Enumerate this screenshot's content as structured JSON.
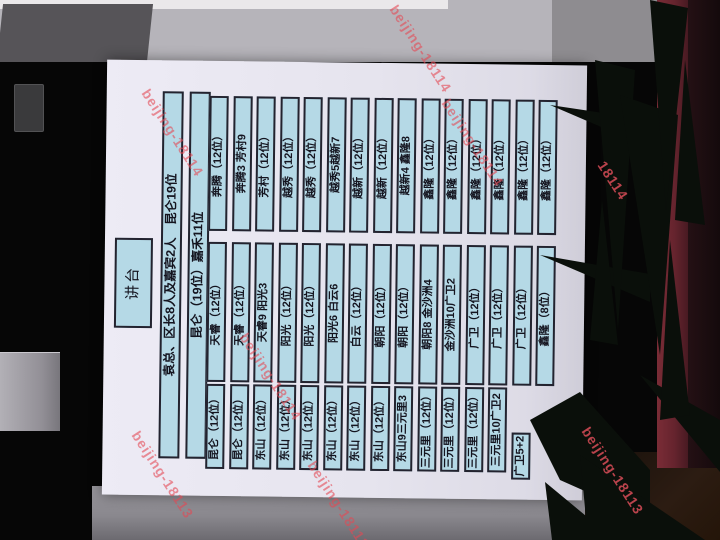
{
  "photo": {
    "watermarks": [
      "beijing-18114",
      "beijing-18114",
      "beijing-18114",
      "beijing-18114",
      "18114",
      "beijing-18113",
      "beijing-18113",
      "beijing-18113"
    ]
  },
  "slide": {
    "podium": "讲台",
    "header_rows": [
      "袁总、区长8人及嘉宾2人　昆仑19位",
      "昆仑（19位）嘉禾11位"
    ],
    "seating": {
      "columns": [
        "left",
        "middle",
        "right"
      ],
      "rows": [
        {
          "left": "昆仑（12位）",
          "middle": "天睿（12位）",
          "right": "奔腾（12位）"
        },
        {
          "left": "昆仑（12位）",
          "middle": "天睿（12位）",
          "right": "奔腾3 芳村9"
        },
        {
          "left": "东山（12位）",
          "middle": "天睿9 阳光3",
          "right": "芳村（12位）"
        },
        {
          "left": "东山（12位）",
          "middle": "阳光（12位）",
          "right": "越秀（12位）"
        },
        {
          "left": "东山（12位）",
          "middle": "阳光（12位）",
          "right": "越秀（12位）"
        },
        {
          "left": "东山（12位）",
          "middle": "阳光6 白云6",
          "right": "越秀5越新7"
        },
        {
          "left": "东山（12位）",
          "middle": "白云（12位）",
          "right": "越新（12位）"
        },
        {
          "left": "东山（12位）",
          "middle": "朝阳（12位）",
          "right": "越新（12位）"
        },
        {
          "left": "东山9三元里3",
          "middle": "朝阳（12位）",
          "right": "越新4 鑫隆8"
        },
        {
          "left": "三元里（12位）",
          "middle": "朝阳8 金沙洲4",
          "right": "鑫隆（12位）"
        },
        {
          "left": "三元里（12位）",
          "middle": "金沙洲10广卫2",
          "right": "鑫隆（12位）"
        },
        {
          "left": "三元里（12位）",
          "middle": "广卫（12位）",
          "right": "鑫隆（12位）"
        },
        {
          "left": "三元里10广卫2",
          "middle": "广卫（12位）",
          "right": "鑫隆（12位）"
        },
        {
          "left": "广卫5+2",
          "left_short": true,
          "middle": "广卫（12位）",
          "right": "鑫隆（12位）"
        },
        {
          "left": null,
          "middle": "鑫隆（8位）",
          "right": "鑫隆（12位）"
        }
      ]
    }
  },
  "colors": {
    "seat_box_fill": "#b5d9e6",
    "seat_box_border": "#23232f",
    "poster": "#e6e4ee",
    "curtain": "#66242e",
    "watermark": "#e44854"
  }
}
